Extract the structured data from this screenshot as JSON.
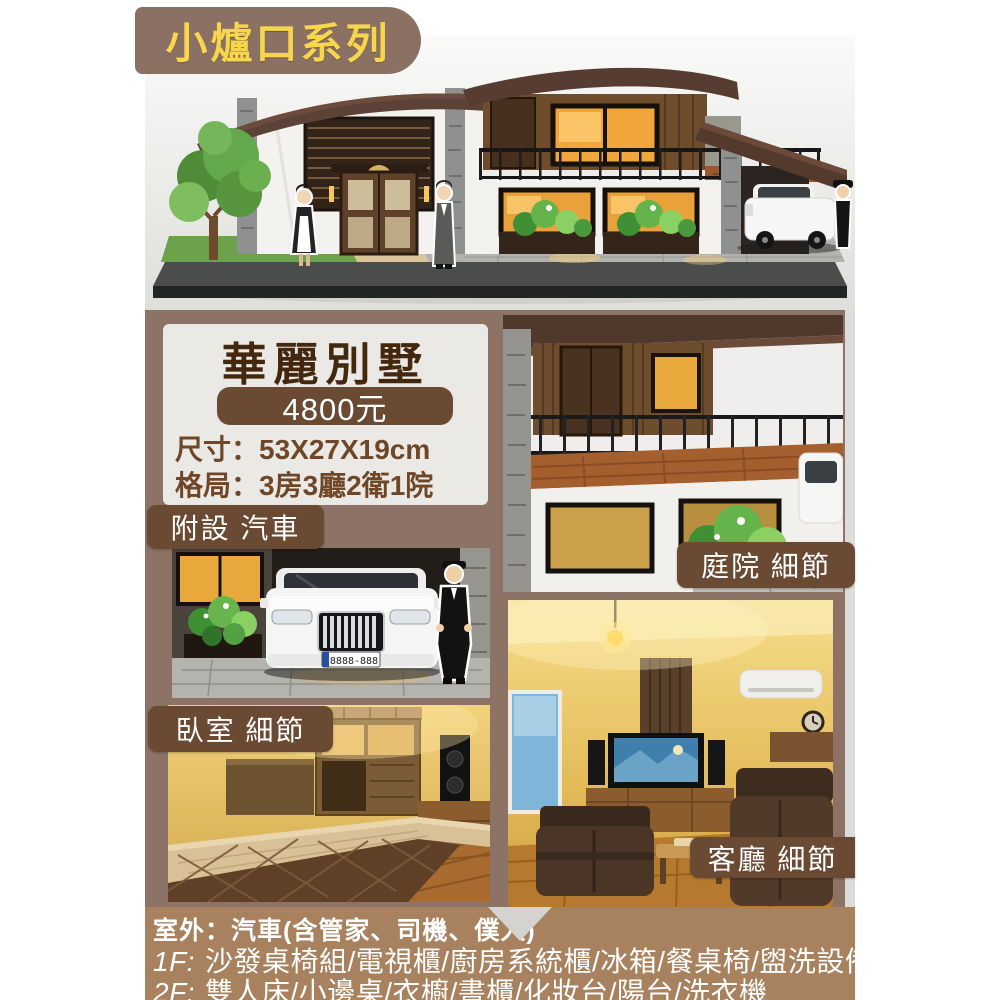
{
  "badge": {
    "label": "小爐口系列"
  },
  "product": {
    "title": "華麗別墅",
    "price": "4800元",
    "specs": [
      "尺寸：53X27X19cm",
      "格局：3房3廳2衛1院"
    ]
  },
  "tags": {
    "car": "附設 汽車",
    "courtyard": "庭院 細節",
    "bedroom": "臥室 細節",
    "living": "客廳 細節"
  },
  "car_plate": "8888-888",
  "footer": {
    "outdoor": "室外：汽車(含管家、司機、僕人)",
    "floors": [
      {
        "prefix": "1F:",
        "items": "沙發桌椅組/電視櫃/廚房系統櫃/冰箱/餐桌椅/盥洗設備"
      },
      {
        "prefix": "2F:",
        "items": "雙人床/小邊桌/衣櫥/書櫃/化妝台/陽台/洗衣機"
      }
    ]
  },
  "colors": {
    "badge_bg": "#8a7163",
    "badge_text": "#f7d64e",
    "band_bg": "#8d7365",
    "tag_bg": "#6b4a33",
    "panel_bg": "#eae9e6",
    "price_pill_bg": "#6b4a33",
    "title_text": "#43280e",
    "spec_text": "#6f4626",
    "footer_bg": "#a8815e",
    "footer_text": "#ffffff"
  }
}
